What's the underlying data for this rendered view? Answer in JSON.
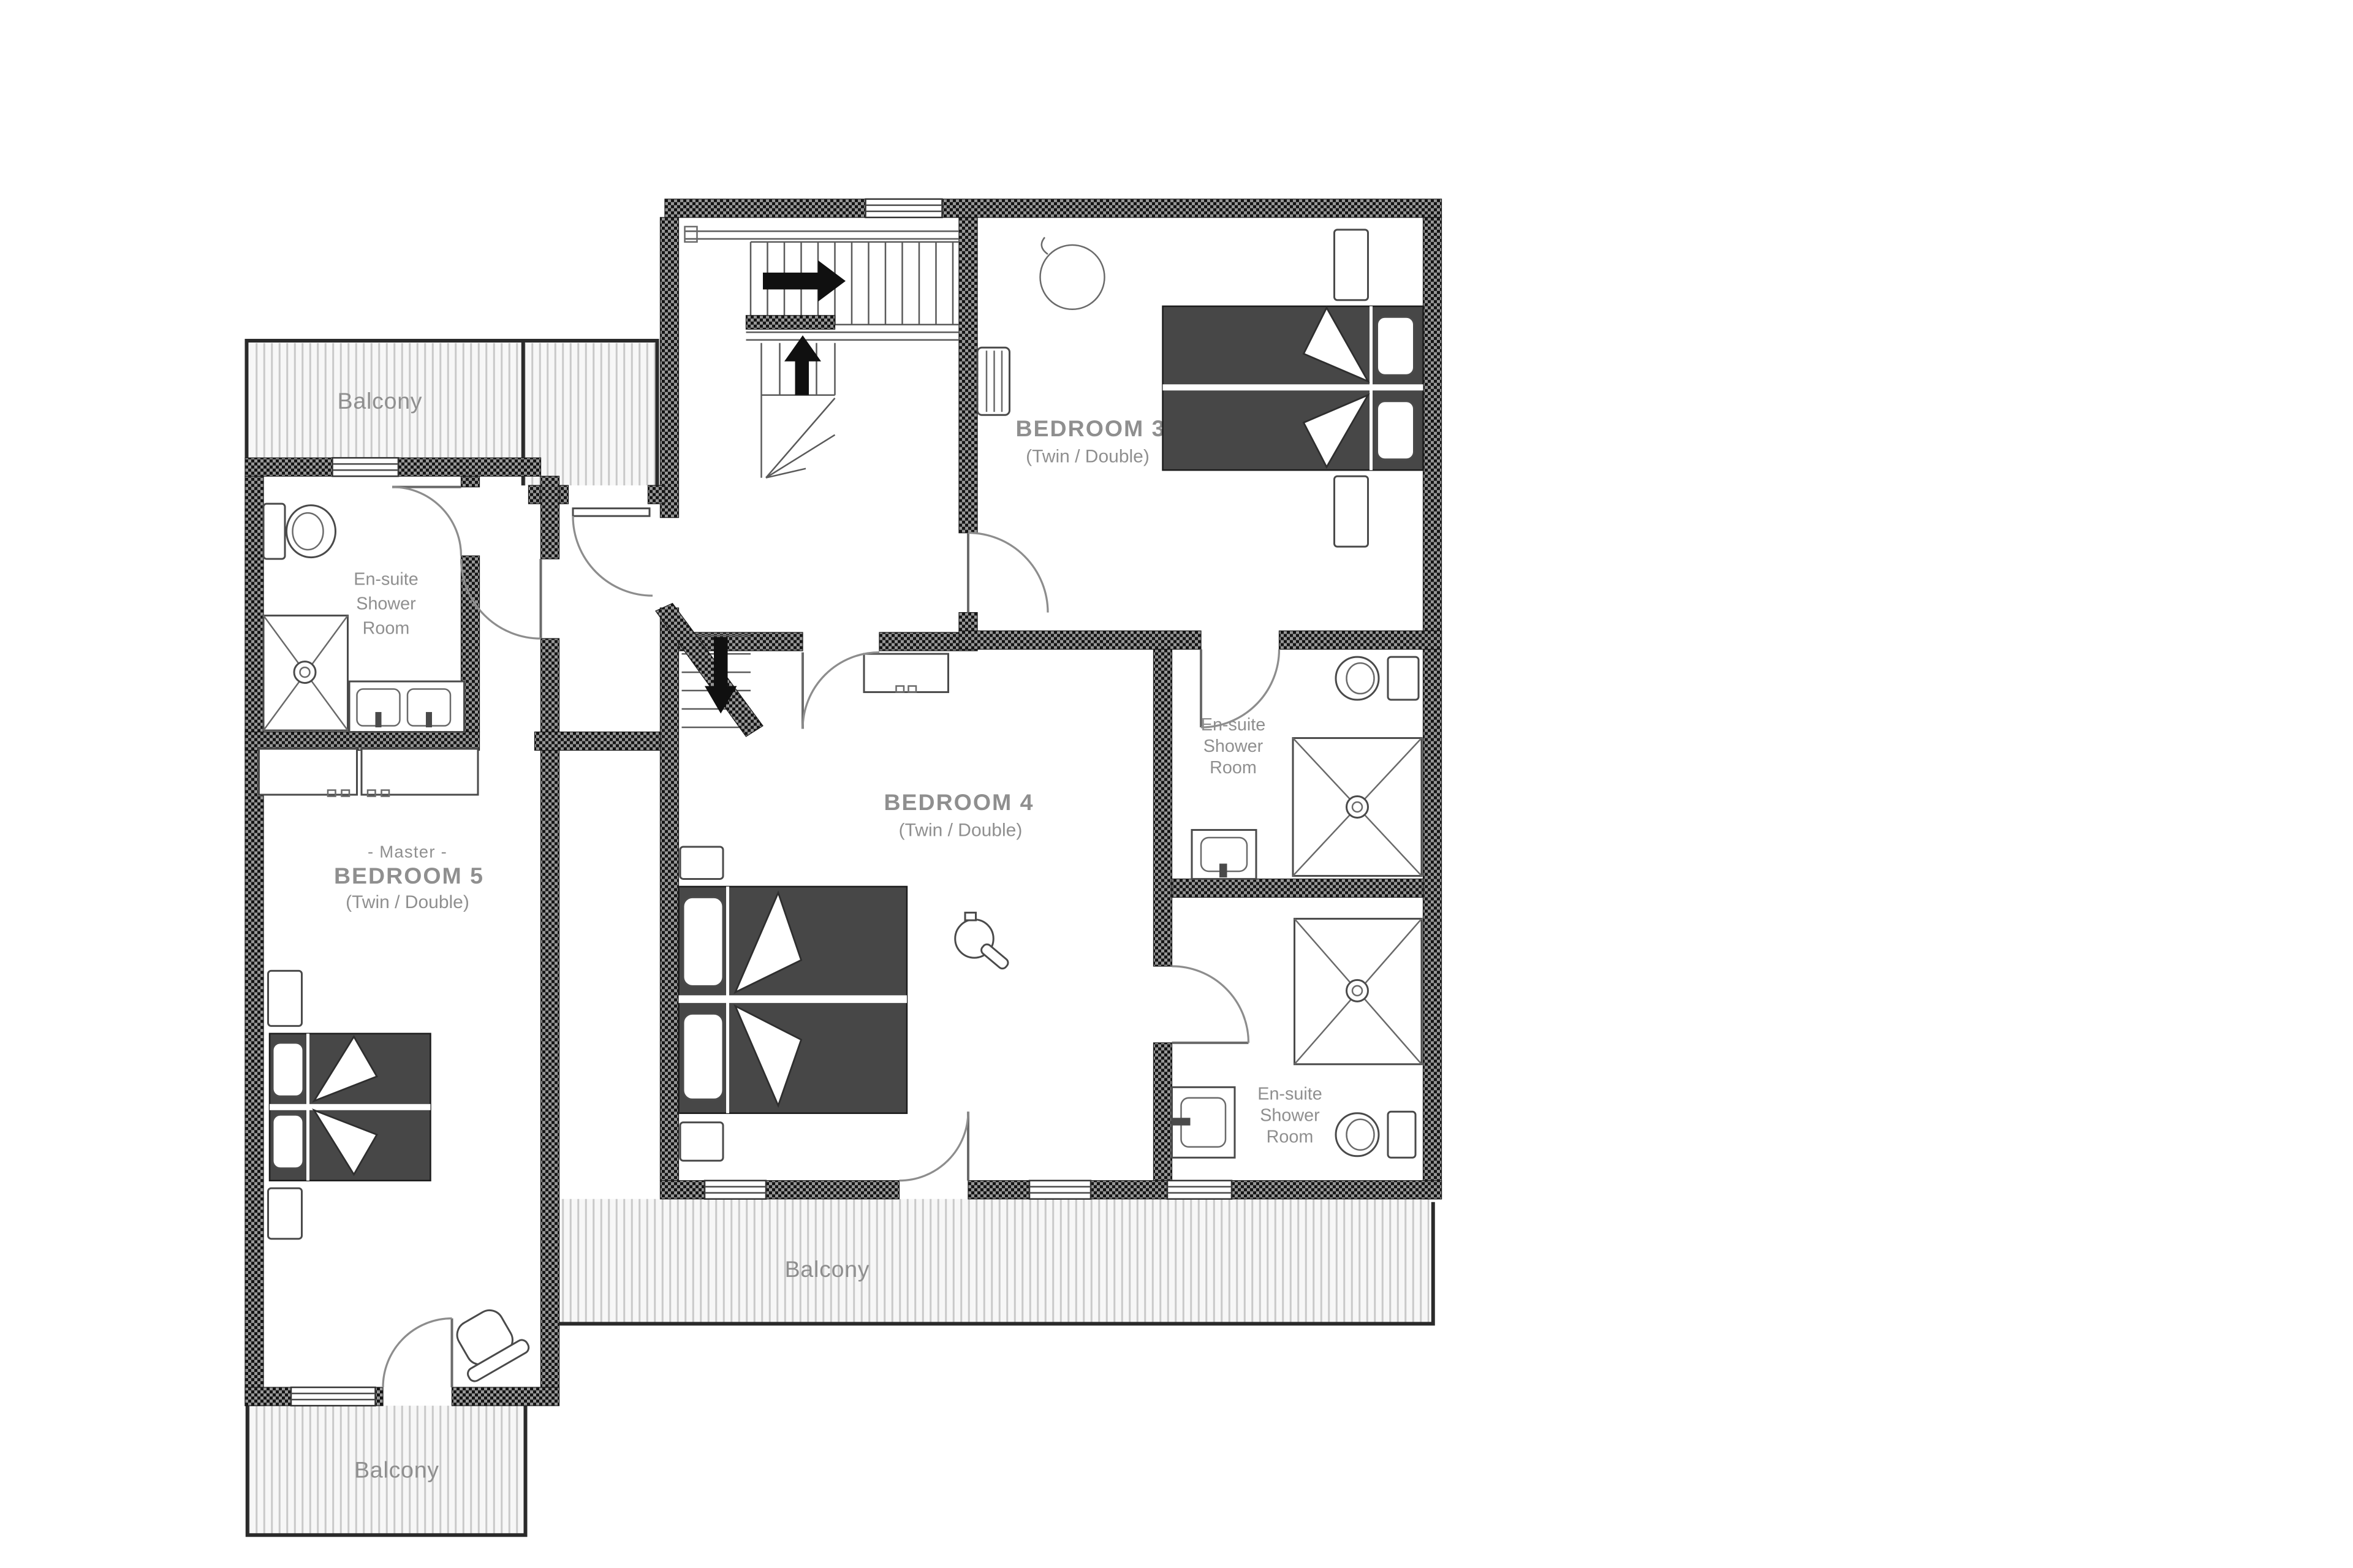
{
  "page": {
    "background": "#ffffff"
  },
  "plan": {
    "balconies": [
      {
        "id": "balcony-top-left",
        "label": "Balcony"
      },
      {
        "id": "balcony-bottom-middle",
        "label": "Balcony"
      },
      {
        "id": "balcony-bottom-left",
        "label": "Balcony"
      }
    ],
    "rooms": {
      "bedroom3": {
        "name": "BEDROOM 3",
        "type": "(Twin / Double)"
      },
      "bedroom4": {
        "name": "BEDROOM 4",
        "type": "(Twin / Double)"
      },
      "bedroom5": {
        "prefix": "- Master -",
        "name": "BEDROOM 5",
        "type": "(Twin / Double)"
      },
      "ensuite5": {
        "lines": [
          "En-suite",
          "Shower",
          "Room"
        ]
      },
      "ensuite3": {
        "lines": [
          "En-suite",
          "Shower",
          "Room"
        ]
      },
      "ensuite4": {
        "lines": [
          "En-suite",
          "Shower",
          "Room"
        ]
      }
    },
    "colors": {
      "wall_dark": "#141414",
      "wall_mid": "#979797",
      "mattress": "#474747",
      "label": "#8f8f8f",
      "outline": "#4a4a4a",
      "hatch_line": "#c9c9c9",
      "balcony_fill": "#f7f7f7",
      "arrow": "#101010"
    }
  }
}
